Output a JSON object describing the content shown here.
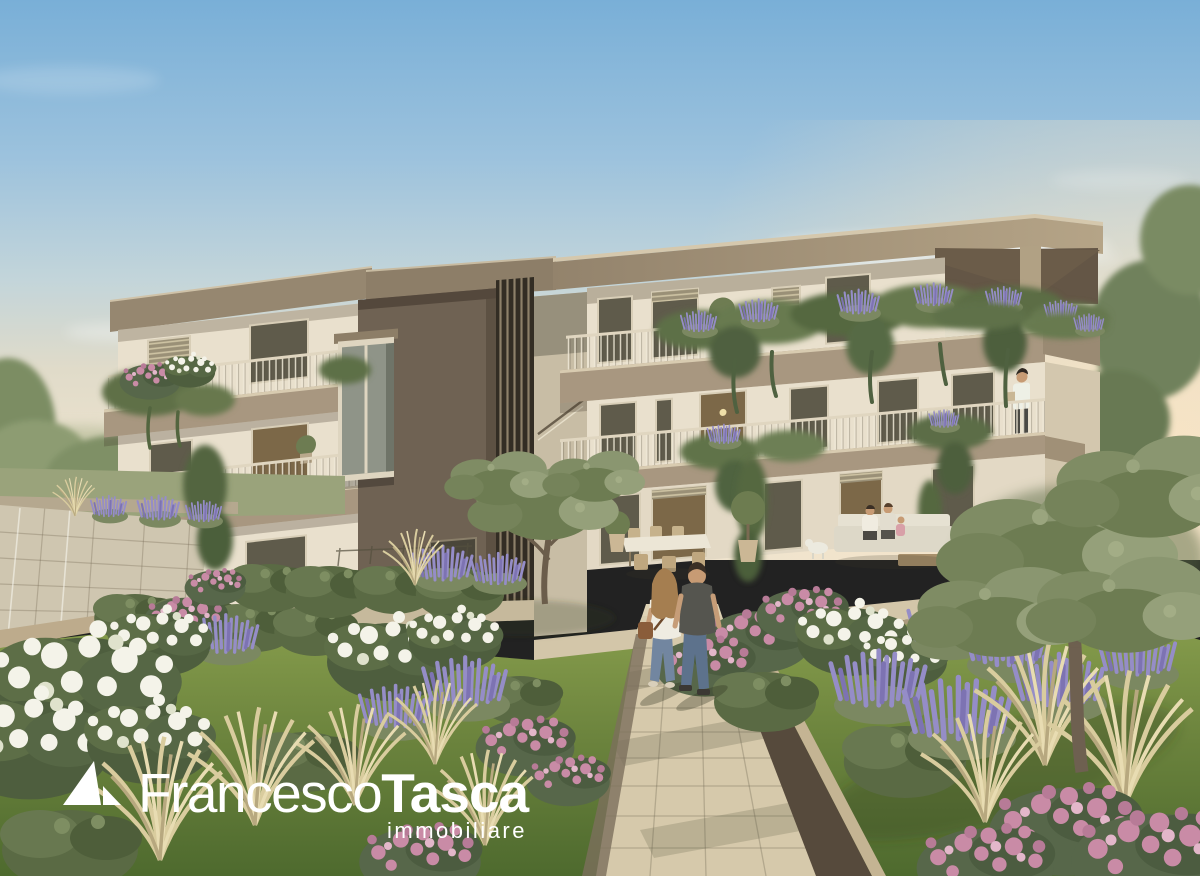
{
  "brand": {
    "name_light": "Francesco",
    "name_bold": "Tasca",
    "tagline": "immobiliare",
    "logo_color": "#ffffff"
  },
  "palette": {
    "sky_top": "#79afd7",
    "sky_horizon": "#efe4cf",
    "facade_cream": "#e9e0cd",
    "balcony_taupe": "#a89780",
    "tower_brown": "#6f6253",
    "roof_taupe": "#9a8a72",
    "lawn_green": "#6b833d",
    "lavender": "#958dc7",
    "flower_pink": "#c98ba6",
    "flower_white": "#f4f3e9",
    "path_beige": "#d6c9ab",
    "foliage_olive": "#7d8a62"
  }
}
